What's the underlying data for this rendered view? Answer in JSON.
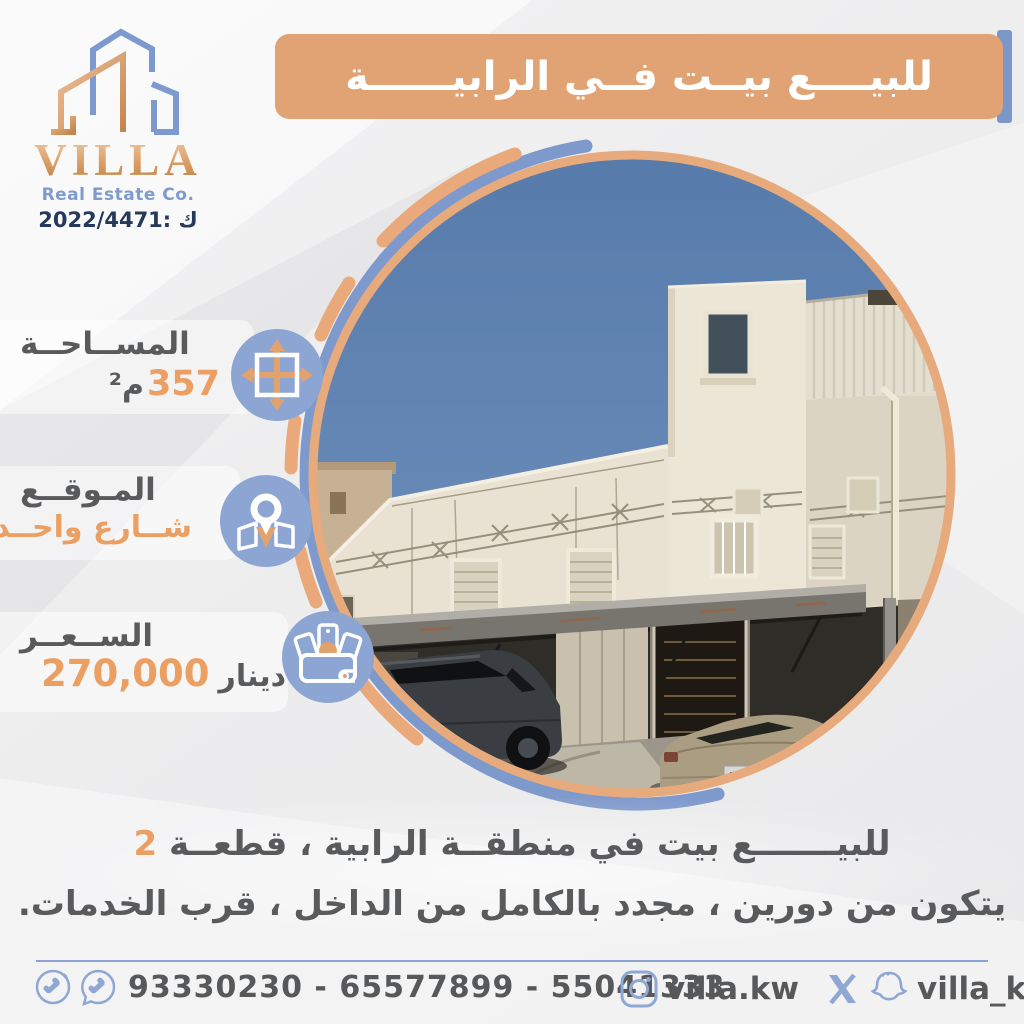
{
  "brand": {
    "name": "VILLA",
    "tagline": "Real Estate Co.",
    "license": "2022/4471: ك"
  },
  "header": {
    "title": "للبيــــع بيــت فــي الرابيــــــة"
  },
  "specs": [
    {
      "label": "المســاحــة",
      "value": "357",
      "unit": "م²",
      "icon": "expand-arrows-icon"
    },
    {
      "label": "المـوقــع",
      "value": "شــارع واحــد",
      "unit": "",
      "icon": "map-pin-icon"
    },
    {
      "label": "الســعــر",
      "value": "270,000",
      "unit": "دينار",
      "icon": "wallet-cash-icon"
    }
  ],
  "description": {
    "line1": "للبيـــــــع بيت في منطقــة الرابية ، قطعــة",
    "highlight": "2",
    "line2": "يتكون من دورين ، مجدد بالكامل من الداخل ، قرب الخدمات."
  },
  "footer": {
    "phones": "93330230 - 65577899 - 55041333",
    "instagram_handle": "villa.kw",
    "social_handle": "villa_kw"
  },
  "photo": {
    "alt": "two-storey cream house with roof tower, metal carport canopy and two parked cars"
  },
  "colors": {
    "orange": "#e1a274",
    "blue": "#8ca5d2",
    "navy": "#24395c",
    "text": "#595a5c",
    "highlight": "#ec9f63"
  }
}
